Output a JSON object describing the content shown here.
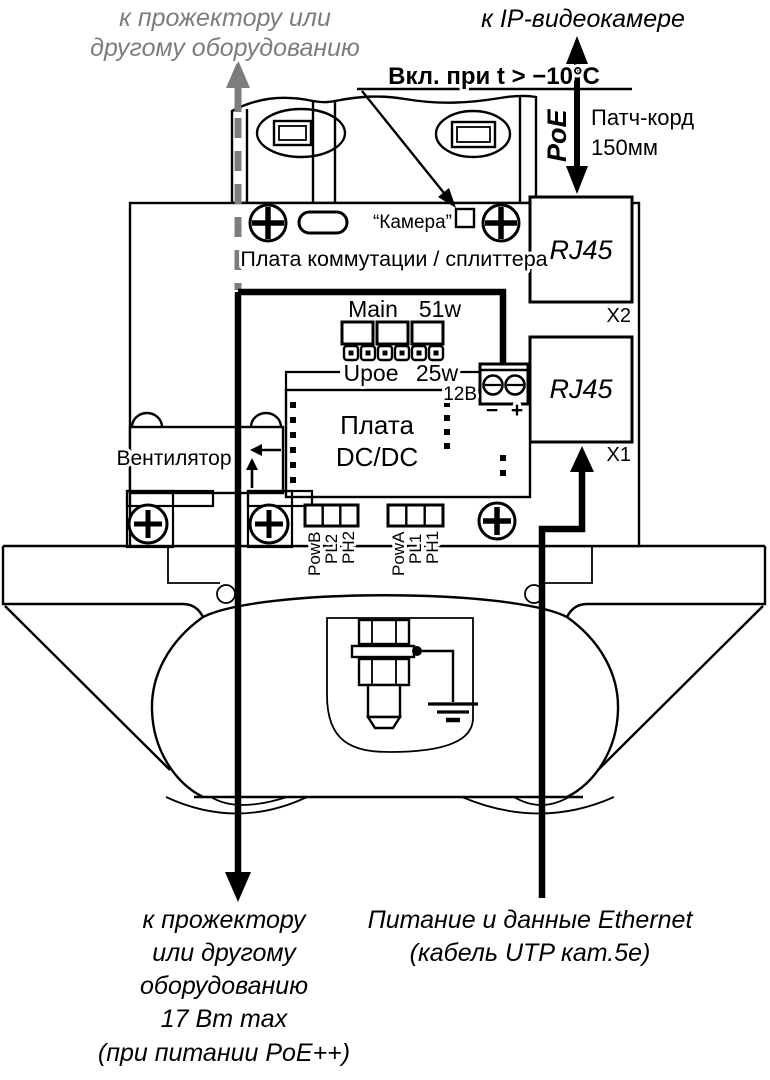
{
  "colors": {
    "ink": "#000000",
    "gray_annotation": "#7d7d7d",
    "background": "#ffffff"
  },
  "top_left_label": {
    "lines": [
      "к прожектору или",
      "другому оборудованию"
    ]
  },
  "top_right_label": "к IP-видеокамере",
  "heater_note": "Вкл. при t > −10°C",
  "poe": {
    "arrow_label": "PoE",
    "patch_cord": [
      "Патч-корд",
      "150мм"
    ]
  },
  "camera_indicator": {
    "label": "“Камера”"
  },
  "splitter_board": {
    "title": "Плата коммутации / сплиттера",
    "connectors": [
      {
        "label": "RJ45",
        "designator": "X2"
      },
      {
        "label": "RJ45",
        "designator": "X1"
      }
    ]
  },
  "jumpers": {
    "main_label": "Main",
    "main_power": "51w",
    "upoe_label": "Upoe",
    "upoe_power": "25w"
  },
  "dc_terminal": {
    "voltage": "12В",
    "minus": "−",
    "plus": "+"
  },
  "dcdc_board": {
    "lines": [
      "Плата",
      "DC/DC"
    ]
  },
  "fan_label": "Вентилятор",
  "bottom_connectors": {
    "left": [
      "PowB",
      "PL2",
      "PH2"
    ],
    "right": [
      "PowA",
      "PL1",
      "PH1"
    ]
  },
  "bottom_left_label": {
    "lines": [
      "к прожектору",
      "или другому",
      "оборудованию",
      "17 Вт max",
      "(при питании PoE++)"
    ]
  },
  "bottom_right_label": {
    "lines": [
      "Питание и данные Ethernet",
      "(кабель UTP кат.5е)"
    ]
  }
}
